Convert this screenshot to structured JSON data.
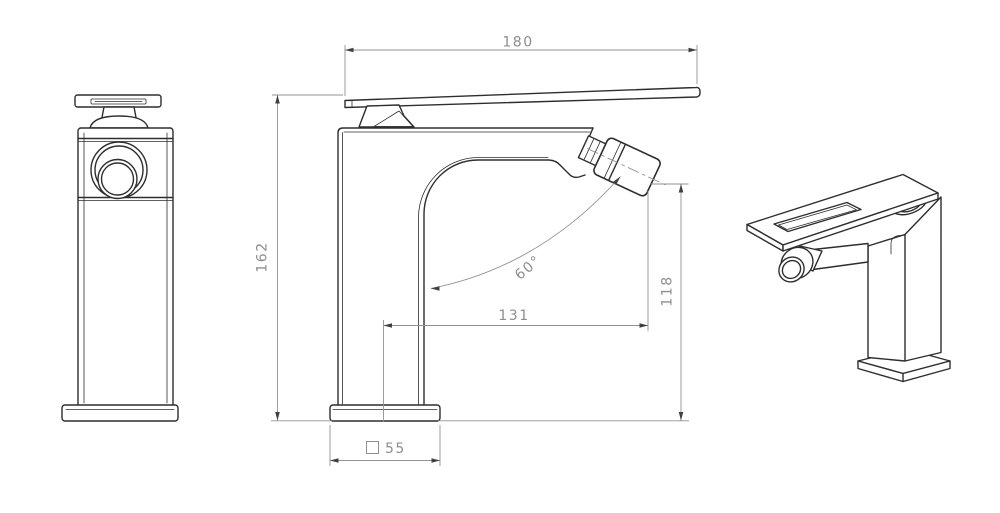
{
  "drawing": {
    "background": "#ffffff",
    "colors": {
      "object_line": "#2e2e2e",
      "dim_line": "#919191",
      "dim_text": "#8e8e8e",
      "arrow": "#404040"
    },
    "dimensions": {
      "handle_length": "180",
      "body_height": "162",
      "spout_outlet_height": "118",
      "handle_reach": "131",
      "spray_angle": "60°",
      "base_width": {
        "symbol": "□",
        "value": "55"
      }
    }
  }
}
